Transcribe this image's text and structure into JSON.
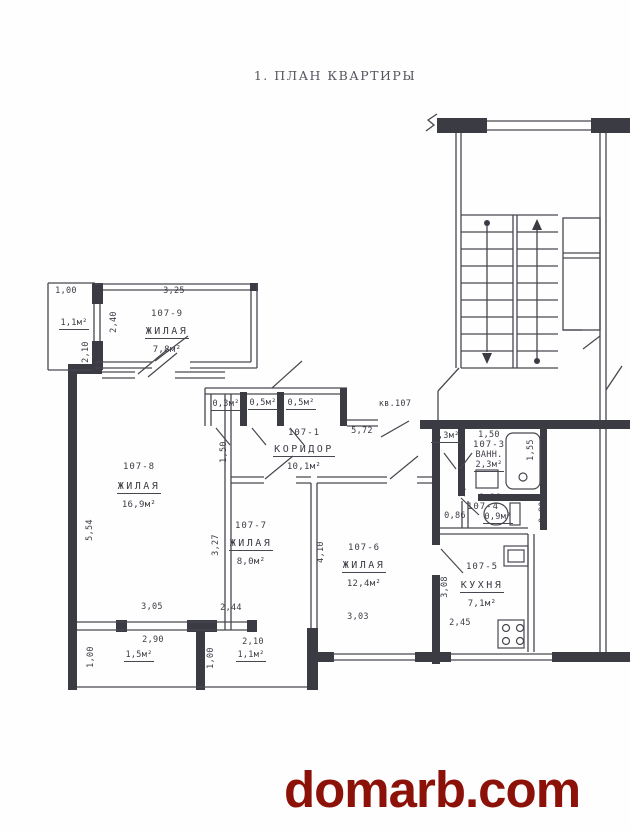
{
  "title": "1.  ПЛАН КВАРТИРЫ",
  "watermark": "domarb.com",
  "apartment_label": "кв.107",
  "rooms": {
    "r9": {
      "id": "107-9",
      "name": "ЖИЛАЯ",
      "area": "7,8м²"
    },
    "r8": {
      "id": "107-8",
      "name": "ЖИЛАЯ",
      "area": "16,9м²"
    },
    "r7": {
      "id": "107-7",
      "name": "ЖИЛАЯ",
      "area": "8,0м²"
    },
    "r6": {
      "id": "107-6",
      "name": "ЖИЛАЯ",
      "area": "12,4м²"
    },
    "r5": {
      "id": "107-5",
      "name": "КУХНЯ",
      "area": "7,1м²"
    },
    "r1": {
      "id": "107-1",
      "name": "КОРИДОР",
      "area": "10,1м²"
    },
    "r3": {
      "id": "107-3",
      "name": "ВАНН.",
      "area": "2,3м²",
      "width_dim": "1,50"
    },
    "r4": {
      "id": "107-4",
      "area": "0,9м²",
      "width_dim": "1,16"
    }
  },
  "closets": {
    "c1": "0,3м²",
    "c2": "0,5м²",
    "c3": "0,5м²",
    "c4": "0,3м²"
  },
  "balconies": {
    "top": "1,1м²",
    "bottom_left": "1,5м²",
    "bottom_mid": "1,1м²"
  },
  "dims": {
    "d100_tl": "1,00",
    "d325": "3,25",
    "d240": "2,40",
    "d210_tl": "2,10",
    "d554": "5,54",
    "d150_corr": "1,50",
    "d572": "5,72",
    "d327": "3,27",
    "d410": "4,10",
    "d308": "3,08",
    "d201": "2,01",
    "d155": "1,55",
    "d086": "0,86",
    "d080": "0,80",
    "d305": "3,05",
    "d290": "2,90",
    "d100_bl": "1,00",
    "d244": "2,44",
    "d210_b": "2,10",
    "d100_bm": "1,00",
    "d303": "3,03",
    "d245": "2,45"
  }
}
